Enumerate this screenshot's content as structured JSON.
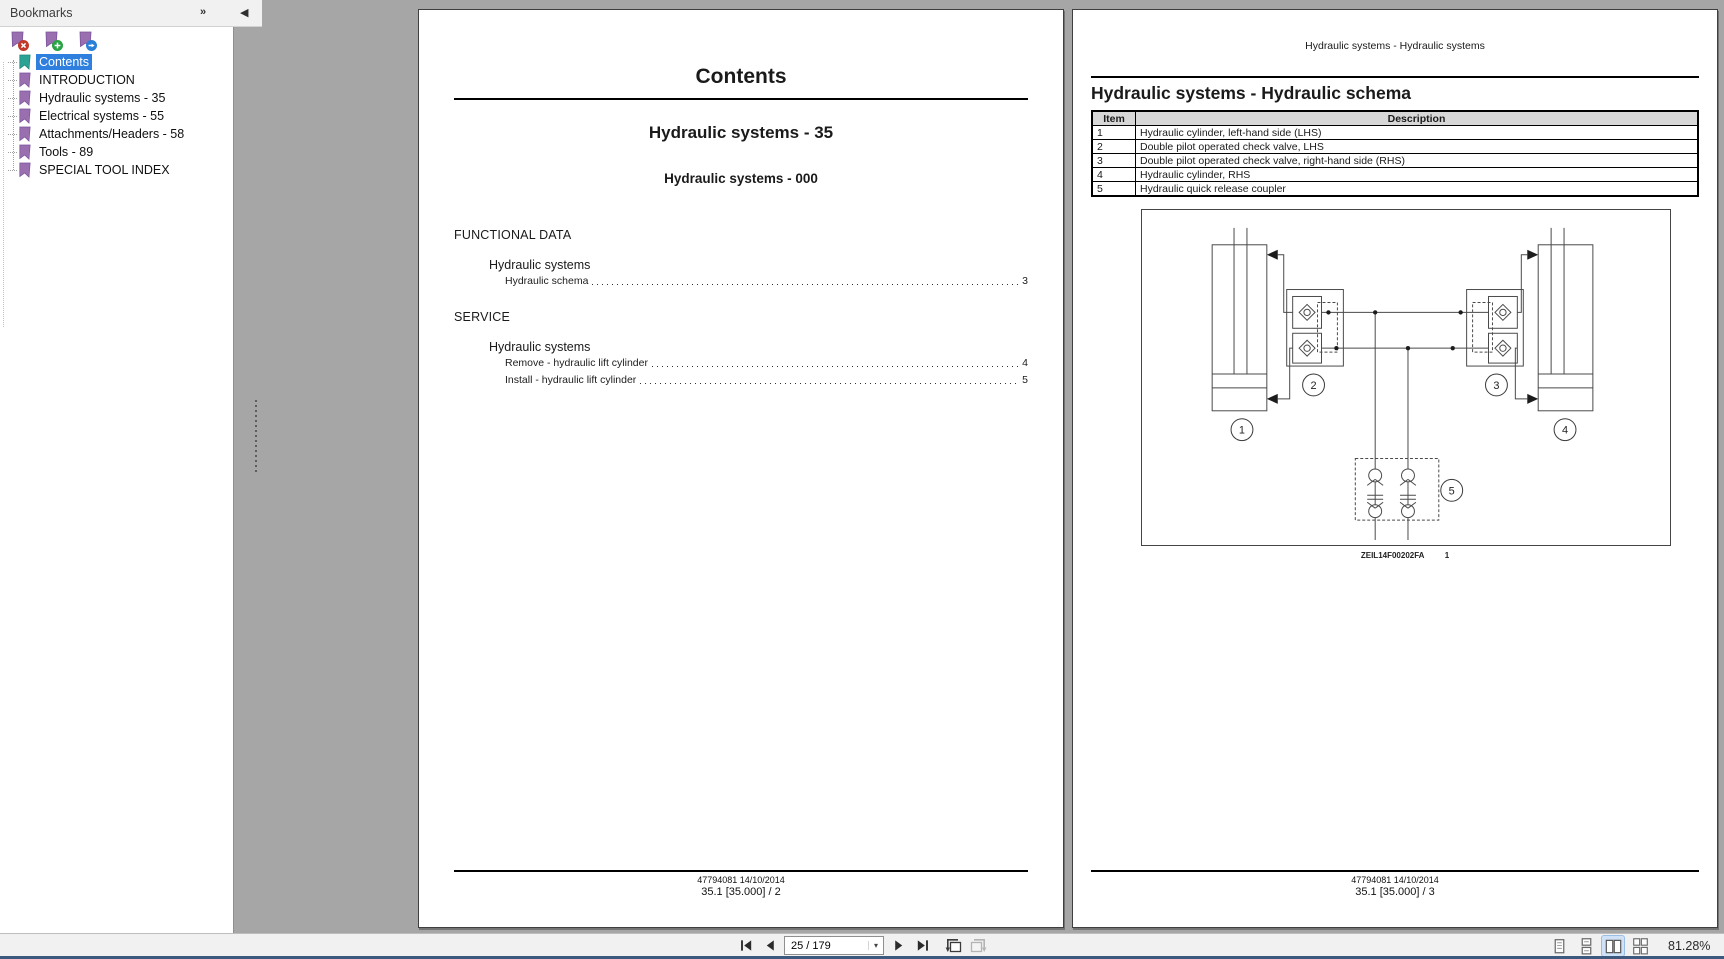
{
  "sidebar": {
    "title": "Bookmarks",
    "items": [
      {
        "label": "Contents",
        "selected": true
      },
      {
        "label": "INTRODUCTION",
        "selected": false
      },
      {
        "label": "Hydraulic systems - 35",
        "selected": false
      },
      {
        "label": "Electrical systems - 55",
        "selected": false
      },
      {
        "label": "Attachments/Headers - 58",
        "selected": false
      },
      {
        "label": "Tools - 89",
        "selected": false
      },
      {
        "label": "SPECIAL TOOL INDEX",
        "selected": false
      }
    ]
  },
  "icons": {
    "panel_expand": "»",
    "panel_collapse": "◀",
    "caret_down": "▾"
  },
  "left_page": {
    "title": "Contents",
    "chapter_heading": "Hydraulic systems - 35",
    "section_heading": "Hydraulic systems - 000",
    "toc": {
      "section1": "FUNCTIONAL DATA",
      "group1": "Hydraulic systems",
      "entry1": {
        "label": "Hydraulic schema",
        "page": "3"
      },
      "section2": "SERVICE",
      "group2": "Hydraulic systems",
      "entry2": {
        "label": "Remove - hydraulic lift cylinder",
        "page": "4"
      },
      "entry3": {
        "label": "Install - hydraulic lift cylinder",
        "page": "5"
      }
    },
    "footer_doc": "47794081 14/10/2014",
    "footer_page": "35.1 [35.000] / 2"
  },
  "right_page": {
    "running_header": "Hydraulic systems - Hydraulic systems",
    "heading": "Hydraulic systems - Hydraulic schema",
    "table": {
      "col_item": "Item",
      "col_desc": "Description",
      "rows": [
        {
          "item": "1",
          "desc": "Hydraulic cylinder, left-hand side (LHS)"
        },
        {
          "item": "2",
          "desc": "Double pilot operated check valve, LHS"
        },
        {
          "item": "3",
          "desc": "Double pilot operated check valve, right-hand side (RHS)"
        },
        {
          "item": "4",
          "desc": "Hydraulic cylinder, RHS"
        },
        {
          "item": "5",
          "desc": "Hydraulic quick release coupler"
        }
      ]
    },
    "diagram_labels": {
      "l1": "1",
      "l2": "2",
      "l3": "3",
      "l4": "4",
      "l5": "5"
    },
    "figure_code": "ZEIL14F00202FA",
    "figure_index": "1",
    "footer_doc": "47794081 14/10/2014",
    "footer_page": "35.1 [35.000] / 3"
  },
  "statusbar": {
    "page_field": "25 / 179",
    "zoom_level": "81.28%"
  },
  "colors": {
    "selection_blue": "#2f7fdf",
    "bookmark_purple": "#9a6fb0",
    "bookmark_teal": "#2ba394",
    "badge_red": "#c0392b",
    "badge_green": "#27a343",
    "badge_blue": "#2980d9",
    "doc_background": "#a6a6a6",
    "active_view_bg": "#cfe2f7"
  }
}
